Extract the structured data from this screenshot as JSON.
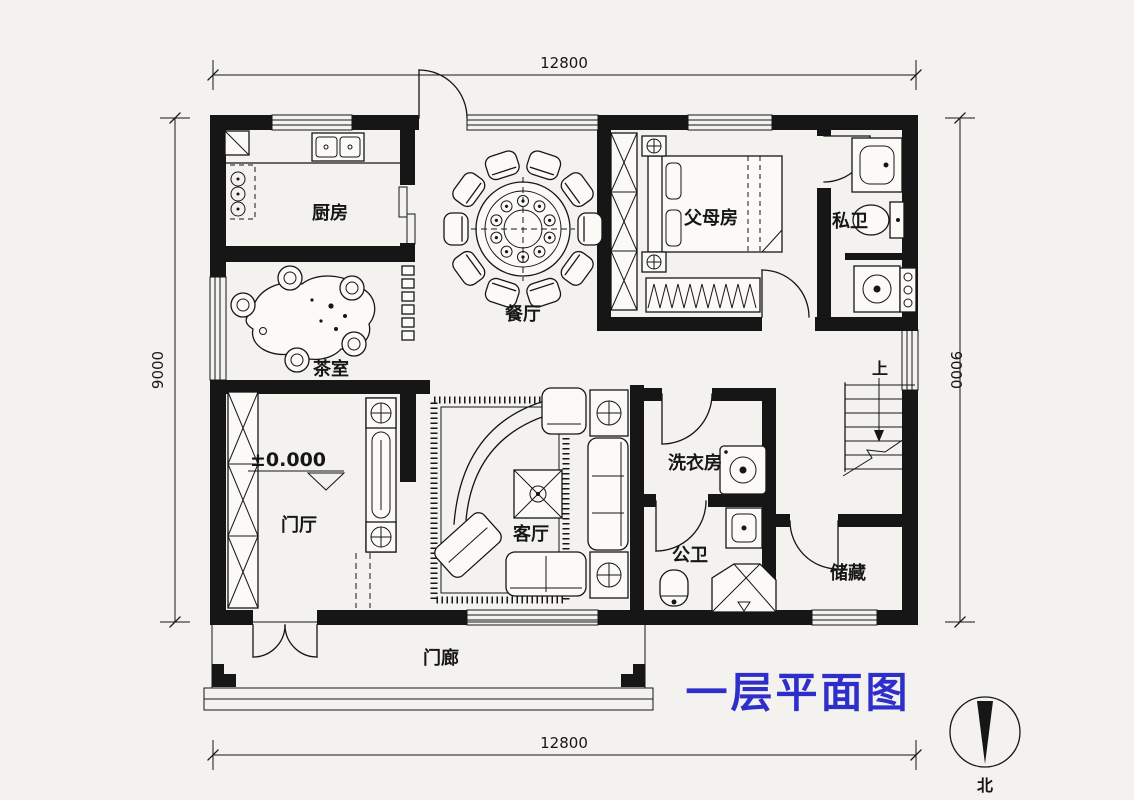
{
  "title": {
    "text": "一层平面图",
    "color": "#2e2ecb"
  },
  "dimensions": {
    "top": "12800",
    "bottom": "12800",
    "left": "9000",
    "right": "9000"
  },
  "rooms": {
    "kitchen": "厨房",
    "dining": "餐厅",
    "parents": "父母房",
    "ensuite": "私卫",
    "tea": "茶室",
    "foyer": "门厅",
    "living": "客厅",
    "laundry": "洗衣房",
    "bath": "公卫",
    "storage": "储藏",
    "porch": "门廊"
  },
  "annotations": {
    "elevation": "±0.000",
    "stairs_up": "上",
    "north": "北"
  }
}
